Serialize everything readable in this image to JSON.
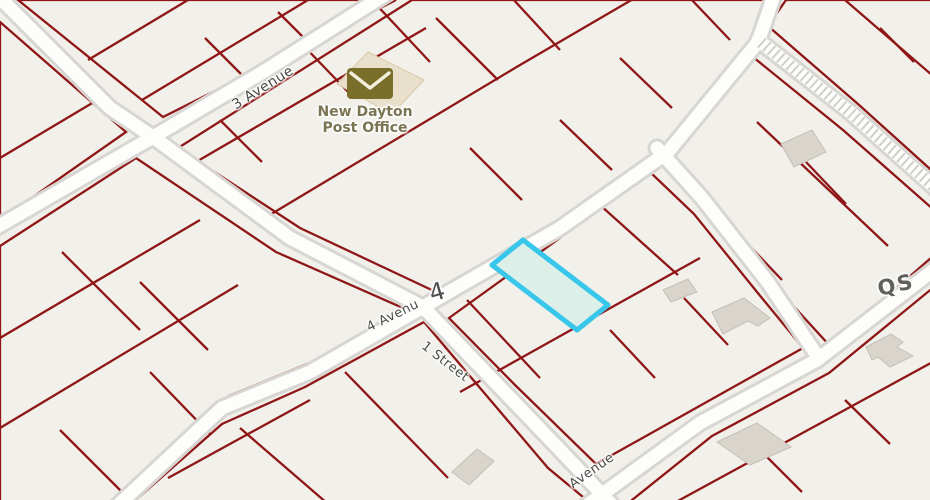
{
  "theme": {
    "map-bg": "#f2f0ea",
    "parcel": "#8f1616",
    "street-casing": "#d8d6d2",
    "street-fill": "#fdfdfc",
    "building": "#d9d5cd",
    "building-stroke": "#c4c0b8",
    "po-building": "#e9e0cb",
    "po-building-stroke": "#d6c9a8",
    "po-icon": "#7a6e2b",
    "po-icon-flap": "#f3efdd",
    "hatch": "#cfcfca",
    "street-label": "#4b4a47",
    "poi-label": "#7b7453",
    "ref-label": "#4f4f4f",
    "qs-label": "#605f5c",
    "highlight-stroke": "#38c7eb",
    "highlight-fill": "#ddefe9"
  },
  "map": {
    "street_labels": {
      "ave3": "3 Avenue",
      "ave4": "4 Avenu",
      "st1": "1 Street",
      "ave5": "Avenue"
    },
    "highway_ref": "4",
    "section_label": "QS",
    "poi": {
      "post_office": {
        "name_line1": "New Dayton",
        "name_line2": "Post Office",
        "icon": "envelope"
      }
    },
    "highlighted_parcel": {
      "stroke": "#38c7eb",
      "fill": "#ddefe9",
      "status": "selected"
    }
  }
}
